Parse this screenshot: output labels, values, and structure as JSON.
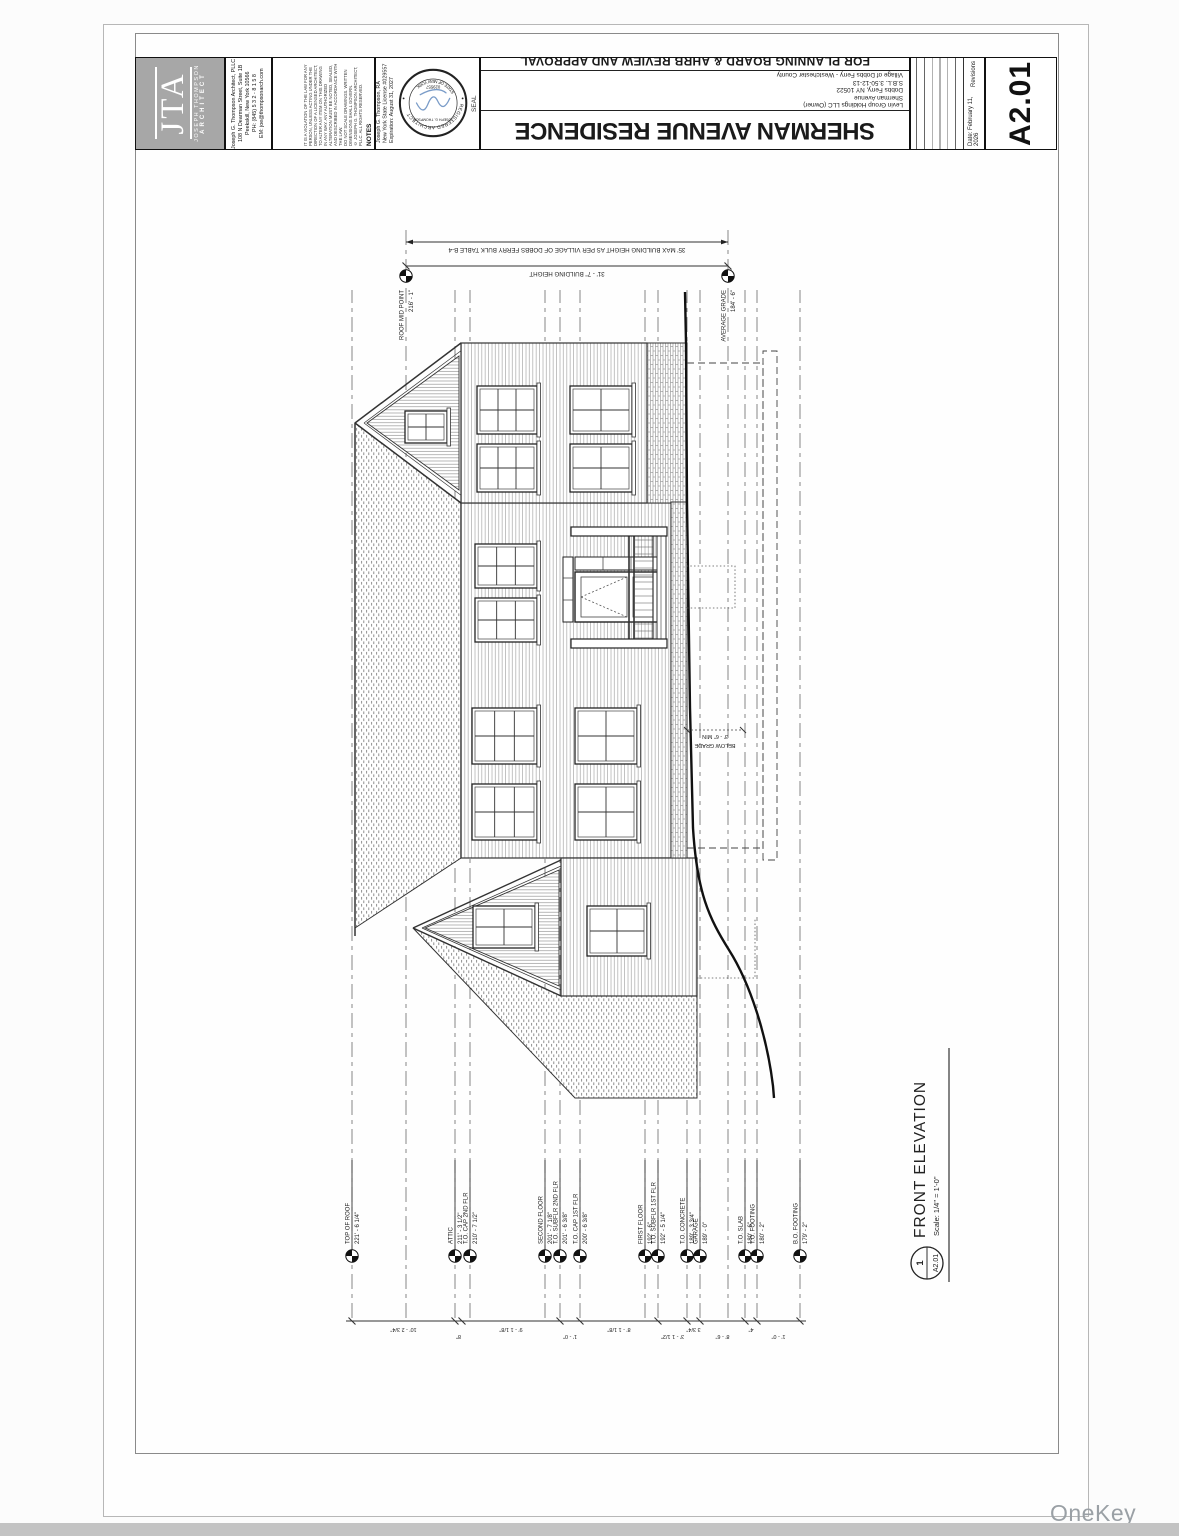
{
  "watermark": "OneKey MLS",
  "titleblock": {
    "sheet_number": "A2.01",
    "date_label": "Date:  February 11, 2026",
    "revisions_label": "Revisions",
    "project_title": "SHERMAN AVENUE RESIDENCE",
    "approval_note": "FOR PLANNING BOARD & AHRB REVIEW AND APPROVAL",
    "project_address": [
      "Levin Group Holdings LLC (Owner)",
      "Sherman Avenue",
      "Dobbs Ferry, NY 10522",
      "S.B.L. 3.50-12-13",
      "Village of Dobbs Ferry - Westchester County"
    ],
    "seal_label": "SEAL",
    "seal": {
      "arc_top": "REGISTERED ARCHITECT",
      "arc_bottom": "STATE OF NEW YORK",
      "name": "JOSEPH G. THOMPSON",
      "number": "029557"
    },
    "license_lines": [
      "Joseph G. Thompson, RA",
      "New York State License #029557",
      "Expiration:  August 31, 2027"
    ],
    "notes_label": "NOTES",
    "notes_lines": [
      "IT IS A VIOLATION OF THE LAW FOR ANY PERSON, UNLESS ACTING UNDER THE DIRECTION OF A LICENSED ARCHITECT, TO ALTER ANY ITEM ON THIS DRAWING IN ANY WAY. ANY AUTHORIZED ALTERATION MUST BE NOTED, SEALED, AND DESCRIBED IN ACCORDANCE WITH THE LAW.",
      "DO NOT SCALE DRAWINGS. WRITTEN DIMENSIONS SHALL GOVERN.",
      "© JOSEPH G. THOMPSON ARCHITECT, PLLC. ALL RIGHTS RESERVED."
    ],
    "firm": {
      "initials": "JTA",
      "name_small": "JOSEPH THOMPSON",
      "title_small": "ARCHITECT",
      "contact_lines": [
        "Joseph G. Thompson Architect, PLLC",
        "108 N Dearman Street, Suite 1B",
        "Peekskill, New York 10566",
        "PH: (845) 5 3 2 - 8 1 5 8",
        "EM: joe@thompsonarch.com"
      ]
    }
  },
  "drawing": {
    "view_number": "1",
    "view_sheet": "A2.01",
    "view_title": "FRONT ELEVATION",
    "view_scale": "Scale:  1/4\" = 1'-0\"",
    "max_height_note": "35' MAX BUILDING HEIGHT AS PER VILLAGE OF DOBBS FERRY BULK TABLE B-4",
    "building_height_note": "31' - 7\" BUILDING HEIGHT",
    "below_grade_label": "BELOW GRADE",
    "below_grade_dim": "3' - 6\" MIN",
    "levels": [
      {
        "name": "TOP OF ROOF",
        "elev": "221' - 6 1/4\"",
        "v": 17
      },
      {
        "name": "ATTIC",
        "elev": "211' - 3 1/2\"",
        "v": 120
      },
      {
        "name": "T.O. CAP 2ND FLR",
        "elev": "210' - 7 1/2\"",
        "v": 135
      },
      {
        "name": "SECOND FLOOR",
        "elev": "201' - 7 1/8\"",
        "v": 210
      },
      {
        "name": "T.O. SUBFLR 2ND FLR",
        "elev": "201' - 6 3/8\"",
        "v": 225
      },
      {
        "name": "T.O. CAP 1ST FLR",
        "elev": "200' - 6 3/8\"",
        "v": 245
      },
      {
        "name": "FIRST FLOOR",
        "elev": "192' - 6\"",
        "v": 310
      },
      {
        "name": "T.O. SUBFLR 1ST FLR",
        "elev": "192' - 5 1/4\"",
        "v": 323
      },
      {
        "name": "T.O. CONCRETE",
        "elev": "189' - 3 3/4\"",
        "v": 352
      },
      {
        "name": "GARAGE",
        "elev": "189' - 0\"",
        "v": 365
      },
      {
        "name": "T.O. SLAB",
        "elev": "180' - 6\"",
        "v": 410
      },
      {
        "name": "T.O. FOOTING",
        "elev": "180' - 2\"",
        "v": 422
      },
      {
        "name": "B.O. FOOTING",
        "elev": "179' - 2\"",
        "v": 465
      }
    ],
    "right_markers": [
      {
        "name": "ROOF MID POINT",
        "elev": "216' - 1\"",
        "v": 71
      },
      {
        "name": "AVERAGE GRADE",
        "elev": "184' - 6\"",
        "v": 393
      }
    ],
    "dim_ticks": [
      17,
      120,
      127,
      225,
      245,
      323,
      352,
      365,
      410,
      422,
      465
    ],
    "dim_labels": [
      "10' - 2 3/4\"",
      "8\"",
      "9' - 1 1/8\"",
      "1' - 0\"",
      "8' - 1 1/8\"",
      "3' - 1 1/2\"",
      "3 3/4\"",
      "8' - 6\"",
      "4\"",
      "1' - 0\""
    ]
  }
}
